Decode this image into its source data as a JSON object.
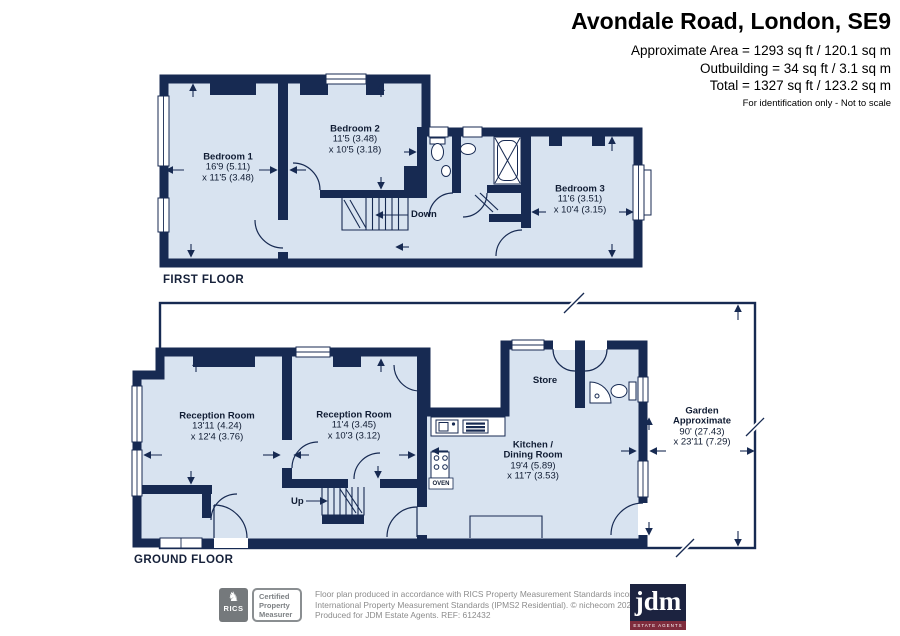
{
  "header": {
    "title": "Avondale Road, London, SE9",
    "area_line1": "Approximate Area = 1293 sq ft / 120.1 sq m",
    "area_line2": "Outbuilding = 34 sq ft / 3.1 sq m",
    "area_line3": "Total = 1327 sq ft / 123.2 sq m",
    "note": "For identification only - Not to scale"
  },
  "first_floor": {
    "caption": "FIRST FLOOR",
    "stairs_label": "Down",
    "rooms": [
      {
        "name": "Bedroom 1",
        "dim1": "16'9 (5.11)",
        "dim2": "x 11'5 (3.48)"
      },
      {
        "name": "Bedroom 2",
        "dim1": "11'5 (3.48)",
        "dim2": "x 10'5 (3.18)"
      },
      {
        "name": "Bedroom 3",
        "dim1": "11'6 (3.51)",
        "dim2": "x 10'4 (3.15)"
      }
    ]
  },
  "ground_floor": {
    "caption": "GROUND FLOOR",
    "stairs_label": "Up",
    "oven_label": "OVEN",
    "rooms": [
      {
        "name": "Reception Room",
        "dim1": "13'11 (4.24)",
        "dim2": "x 12'4 (3.76)"
      },
      {
        "name": "Reception Room",
        "dim1": "11'4 (3.45)",
        "dim2": "x 10'3 (3.12)"
      },
      {
        "name1": "Kitchen /",
        "name2": "Dining Room",
        "dim1": "19'4 (5.89)",
        "dim2": "x 11'7 (3.53)"
      },
      {
        "name": "Store"
      },
      {
        "name1": "Garden",
        "name2": "Approximate",
        "dim1": "90' (27.43)",
        "dim2": "x 23'11 (7.29)"
      }
    ]
  },
  "footer": {
    "rics_logo": "RICS",
    "cert_line1": "Certified",
    "cert_line2": "Property",
    "cert_line3": "Measurer",
    "disclaimer_line1": "Floor plan produced in accordance with RICS Property Measurement Standards incorporating",
    "disclaimer_line2": "International Property Measurement Standards (IPMS2 Residential). © nichecom 2020.",
    "disclaimer_line3": "Produced for JDM Estate Agents. REF: 612432",
    "jdm_logo": "jdm",
    "jdm_sub": "ESTATE AGENTS"
  },
  "colors": {
    "wall_navy": "#172a52",
    "room_fill": "#d8e3f0",
    "garden_fill": "#ffffff",
    "footer_gray": "#8c8c8c",
    "jdm_navy": "#1c2340",
    "jdm_red": "#7e2c3c"
  }
}
